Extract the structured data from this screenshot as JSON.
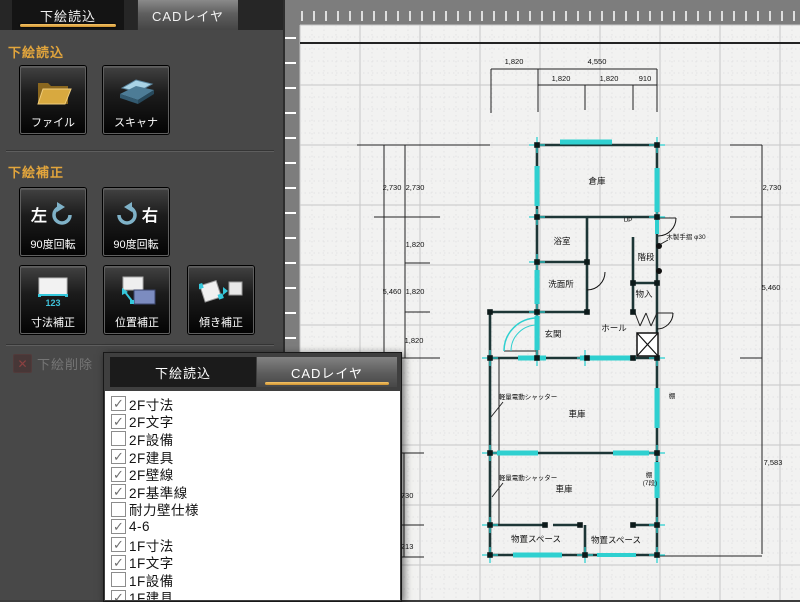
{
  "sidebar": {
    "tabs": [
      {
        "label": "下絵読込",
        "active": true
      },
      {
        "label": "CADレイヤ",
        "active": false
      }
    ],
    "section_load": {
      "title": "下絵読込",
      "buttons": [
        {
          "label": "ファイル",
          "icon": "folder-icon"
        },
        {
          "label": "スキャナ",
          "icon": "scanner-icon"
        }
      ]
    },
    "section_correct": {
      "title": "下絵補正",
      "rotate_left": {
        "label_top": "左",
        "label": "90度回転",
        "icon": "rotate-left-icon"
      },
      "rotate_right": {
        "label_top": "右",
        "label": "90度回転",
        "icon": "rotate-right-icon"
      },
      "buttons": [
        {
          "label": "寸法補正",
          "icon": "dimension-correct-icon",
          "icon_text": "123"
        },
        {
          "label": "位置補正",
          "icon": "position-correct-icon"
        },
        {
          "label": "傾き補正",
          "icon": "tilt-correct-icon"
        }
      ]
    },
    "delete_button": {
      "label": "下絵削除",
      "disabled": true,
      "icon": "delete-x-icon"
    }
  },
  "layer_panel": {
    "tabs": [
      {
        "label": "下絵読込",
        "active": false
      },
      {
        "label": "CADレイヤ",
        "active": true
      }
    ],
    "layers": [
      {
        "label": "2F寸法",
        "checked": true
      },
      {
        "label": "2F文字",
        "checked": true
      },
      {
        "label": "2F設備",
        "checked": false
      },
      {
        "label": "2F建具",
        "checked": true
      },
      {
        "label": "2F壁線",
        "checked": true
      },
      {
        "label": "2F基準線",
        "checked": true
      },
      {
        "label": "耐力壁仕様",
        "checked": false
      },
      {
        "label": "4-6",
        "checked": true
      },
      {
        "label": "1F寸法",
        "checked": true
      },
      {
        "label": "1F文字",
        "checked": true
      },
      {
        "label": "1F設備",
        "checked": false
      },
      {
        "label": "1F建具",
        "checked": true
      }
    ]
  },
  "colors": {
    "accent_orange": "#dba23f",
    "wall": "#1d3636",
    "cyan": "#2fd0d0",
    "canvas_bg": "#f2f2f1",
    "ruler_gray": "#7d7d7d"
  },
  "plan": {
    "border_line": [
      300,
      43,
      800,
      43
    ],
    "walls": [
      [
        537,
        145,
        657,
        145
      ],
      [
        537,
        145,
        537,
        358
      ],
      [
        657,
        145,
        657,
        358
      ],
      [
        537,
        217,
        657,
        217
      ],
      [
        537,
        262,
        587,
        262
      ],
      [
        587,
        217,
        587,
        312
      ],
      [
        490,
        312,
        587,
        312
      ],
      [
        490,
        312,
        490,
        358
      ],
      [
        633,
        237,
        633,
        312
      ],
      [
        633,
        283,
        657,
        283
      ],
      [
        490,
        358,
        657,
        358
      ],
      [
        490,
        358,
        490,
        555
      ],
      [
        657,
        358,
        657,
        555
      ],
      [
        490,
        453,
        657,
        453
      ],
      [
        490,
        525,
        545,
        525
      ],
      [
        553,
        525,
        580,
        525
      ],
      [
        633,
        525,
        657,
        525
      ],
      [
        585,
        525,
        585,
        555
      ],
      [
        490,
        555,
        657,
        555
      ]
    ],
    "thin_lines": [
      [
        499,
        358,
        499,
        525
      ],
      [
        503,
        402,
        491,
        417
      ],
      [
        503,
        483,
        492,
        497
      ],
      [
        668,
        240,
        659,
        245
      ],
      [
        635,
        313,
        640,
        326
      ],
      [
        640,
        326,
        646,
        313
      ],
      [
        646,
        313,
        651,
        326
      ],
      [
        651,
        326,
        657,
        313
      ],
      [
        504,
        351,
        537,
        351
      ],
      [
        657,
        218,
        676,
        218
      ],
      [
        657,
        313,
        673,
        313
      ]
    ],
    "windows": [
      [
        560,
        142,
        612,
        142,
        5
      ],
      [
        537,
        166,
        537,
        206,
        5
      ],
      [
        537,
        270,
        537,
        304,
        5
      ],
      [
        537,
        316,
        537,
        350,
        5
      ],
      [
        657,
        168,
        657,
        212,
        5
      ],
      [
        657,
        220,
        657,
        234,
        4
      ],
      [
        518,
        358,
        546,
        358,
        5
      ],
      [
        580,
        358,
        636,
        358,
        5
      ],
      [
        657,
        388,
        657,
        428,
        5
      ],
      [
        657,
        462,
        657,
        498,
        5
      ],
      [
        497,
        453,
        538,
        453,
        5
      ],
      [
        613,
        453,
        649,
        453,
        5
      ],
      [
        513,
        555,
        562,
        555,
        5
      ],
      [
        597,
        555,
        636,
        555,
        4
      ]
    ],
    "crosses": [
      [
        537,
        145
      ],
      [
        657,
        145
      ],
      [
        537,
        217
      ],
      [
        657,
        217
      ],
      [
        537,
        262
      ],
      [
        537,
        312
      ],
      [
        490,
        358
      ],
      [
        537,
        358
      ],
      [
        585,
        358
      ],
      [
        657,
        358
      ],
      [
        490,
        453
      ],
      [
        657,
        453
      ],
      [
        490,
        525
      ],
      [
        657,
        525
      ],
      [
        490,
        555
      ],
      [
        585,
        555
      ],
      [
        657,
        555
      ]
    ],
    "posts": [
      [
        537,
        145
      ],
      [
        657,
        145
      ],
      [
        537,
        217
      ],
      [
        657,
        217
      ],
      [
        537,
        262
      ],
      [
        587,
        262
      ],
      [
        537,
        312
      ],
      [
        587,
        312
      ],
      [
        490,
        312
      ],
      [
        490,
        358
      ],
      [
        537,
        358
      ],
      [
        587,
        358
      ],
      [
        633,
        358
      ],
      [
        657,
        358
      ],
      [
        490,
        453
      ],
      [
        657,
        453
      ],
      [
        490,
        525
      ],
      [
        545,
        525
      ],
      [
        580,
        525
      ],
      [
        633,
        525
      ],
      [
        657,
        525
      ],
      [
        490,
        555
      ],
      [
        585,
        555
      ],
      [
        657,
        555
      ],
      [
        633,
        283
      ],
      [
        657,
        283
      ],
      [
        633,
        312
      ]
    ],
    "arcs": [
      {
        "d": "M 676 218 A 18 18 0 0 1 658 236",
        "c": "#111",
        "w": 1
      },
      {
        "d": "M 673 313 A 16 16 0 0 1 657 329",
        "c": "#111",
        "w": 1
      },
      {
        "d": "M 605 272 A 18 18 0 0 1 587 290",
        "c": "#111",
        "w": 1
      },
      {
        "d": "M 537 318 A 33 33 0 0 0 504 351",
        "c": "#2fd0d0",
        "w": 1.5
      },
      {
        "d": "M 537 325 A 26 26 0 0 0 511 351",
        "c": "#2fd0d0",
        "w": 1
      }
    ],
    "xbox": [
      637,
      333,
      21,
      23
    ],
    "dots": [
      [
        659,
        246
      ],
      [
        659,
        271
      ]
    ],
    "dim_lines": [
      [
        491,
        69,
        657,
        69
      ],
      [
        538,
        85,
        657,
        85
      ],
      [
        491,
        69,
        491,
        113
      ],
      [
        538,
        69,
        538,
        112
      ],
      [
        657,
        69,
        657,
        112
      ],
      [
        585,
        85,
        585,
        110
      ],
      [
        633,
        85,
        633,
        110
      ],
      [
        384,
        145,
        384,
        358
      ],
      [
        405,
        145,
        405,
        358
      ],
      [
        357,
        145,
        490,
        145
      ],
      [
        374,
        217,
        440,
        217
      ],
      [
        405,
        263,
        430,
        263
      ],
      [
        405,
        312,
        430,
        312
      ],
      [
        374,
        358,
        440,
        358
      ],
      [
        404,
        453,
        404,
        557
      ],
      [
        396,
        453,
        424,
        453
      ],
      [
        396,
        525,
        424,
        525
      ],
      [
        396,
        557,
        424,
        557
      ],
      [
        762,
        145,
        762,
        554
      ],
      [
        730,
        145,
        762,
        145
      ],
      [
        730,
        217,
        762,
        217
      ],
      [
        740,
        358,
        762,
        358
      ],
      [
        660,
        556,
        762,
        556
      ]
    ],
    "dim_labels": [
      {
        "x": 514,
        "y": 64,
        "t": "1,820"
      },
      {
        "x": 597,
        "y": 64,
        "t": "4,550"
      },
      {
        "x": 561,
        "y": 81,
        "t": "1,820"
      },
      {
        "x": 609,
        "y": 81,
        "t": "1,820"
      },
      {
        "x": 645,
        "y": 81,
        "t": "910"
      },
      {
        "x": 392,
        "y": 190,
        "t": "2,730"
      },
      {
        "x": 415,
        "y": 190,
        "t": "2,730"
      },
      {
        "x": 415,
        "y": 247,
        "t": "1,820"
      },
      {
        "x": 392,
        "y": 294,
        "t": "5,460"
      },
      {
        "x": 415,
        "y": 294,
        "t": "1,820"
      },
      {
        "x": 414,
        "y": 343,
        "t": "1,820"
      },
      {
        "x": 404,
        "y": 498,
        "t": "2,730"
      },
      {
        "x": 404,
        "y": 549,
        "t": "1,213"
      },
      {
        "x": 772,
        "y": 190,
        "t": "2,730"
      },
      {
        "x": 771,
        "y": 290,
        "t": "5,460"
      },
      {
        "x": 773,
        "y": 465,
        "t": "7,583"
      }
    ],
    "room_labels": [
      {
        "x": 597,
        "y": 184,
        "t": "倉庫"
      },
      {
        "x": 562,
        "y": 244,
        "t": "浴室"
      },
      {
        "x": 561,
        "y": 287,
        "t": "洗面所"
      },
      {
        "x": 553,
        "y": 337,
        "t": "玄関"
      },
      {
        "x": 614,
        "y": 331,
        "t": "ホール"
      },
      {
        "x": 646,
        "y": 260,
        "t": "階段"
      },
      {
        "x": 644,
        "y": 297,
        "t": "物入"
      },
      {
        "x": 577,
        "y": 417,
        "t": "車庫"
      },
      {
        "x": 564,
        "y": 492,
        "t": "車庫"
      },
      {
        "x": 536,
        "y": 542,
        "t": "物置スペース"
      },
      {
        "x": 616,
        "y": 543,
        "t": "物置スペース"
      }
    ],
    "notes": [
      {
        "x": 528,
        "y": 399,
        "t": "軽量電動シャッター"
      },
      {
        "x": 528,
        "y": 480,
        "t": "軽量電動シャッター"
      },
      {
        "x": 686,
        "y": 239,
        "t": "木製手摺 φ30"
      },
      {
        "x": 672,
        "y": 398,
        "t": "棚"
      },
      {
        "x": 649,
        "y": 477,
        "t": "棚"
      },
      {
        "x": 650,
        "y": 485,
        "t": "(7段)"
      },
      {
        "x": 628,
        "y": 222,
        "t": "UP"
      }
    ]
  }
}
